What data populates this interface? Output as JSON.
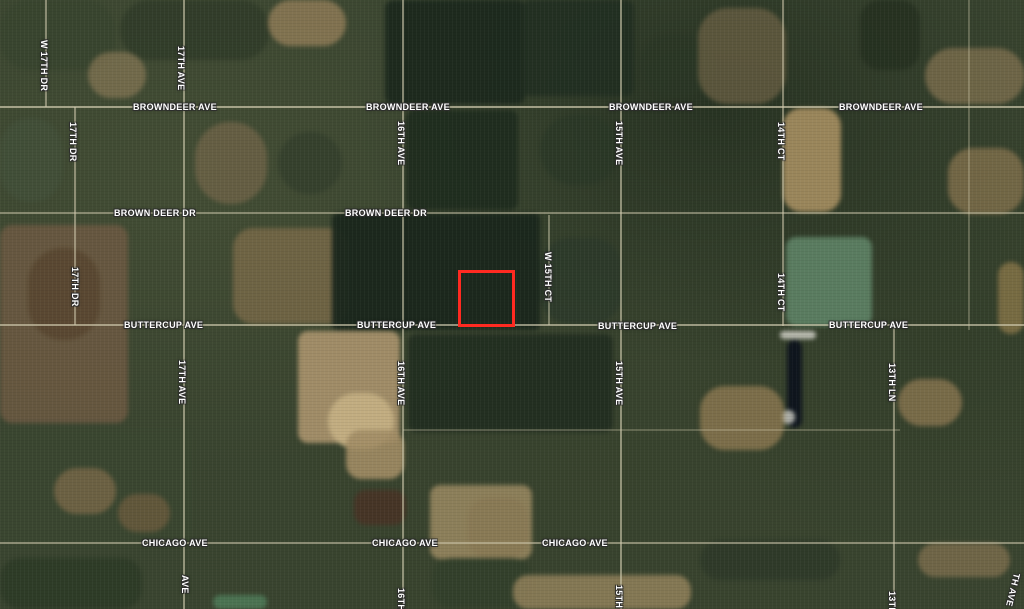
{
  "map": {
    "view": "satellite",
    "highlight": {
      "name": "selected-parcel",
      "x": 458,
      "y": 270,
      "width": 57,
      "height": 57,
      "color": "#ff2a21",
      "stroke_px": 3
    },
    "colors": {
      "label_text": "#ffffff",
      "label_halo": "#2d2d2d",
      "road_line": "#cfc9ad"
    },
    "road_labels": [
      {
        "text": "W 17TH DR",
        "dir": "v",
        "x": 45,
        "y": 40
      },
      {
        "text": "17TH AVE",
        "dir": "v",
        "x": 182,
        "y": 46
      },
      {
        "text": "17TH DR",
        "dir": "v",
        "x": 74,
        "y": 122
      },
      {
        "text": "16TH AVE",
        "dir": "v",
        "x": 402,
        "y": 121
      },
      {
        "text": "15TH AVE",
        "dir": "v",
        "x": 620,
        "y": 121
      },
      {
        "text": "14TH CT",
        "dir": "v",
        "x": 782,
        "y": 122
      },
      {
        "text": "BROWNDEER AVE",
        "dir": "h",
        "x": 133,
        "y": 102
      },
      {
        "text": "BROWNDEER AVE",
        "dir": "h",
        "x": 366,
        "y": 102
      },
      {
        "text": "BROWNDEER AVE",
        "dir": "h",
        "x": 609,
        "y": 102
      },
      {
        "text": "BROWNDEER AVE",
        "dir": "h",
        "x": 839,
        "y": 102
      },
      {
        "text": "BROWN DEER DR",
        "dir": "h",
        "x": 114,
        "y": 208
      },
      {
        "text": "BROWN DEER DR",
        "dir": "h",
        "x": 345,
        "y": 208
      },
      {
        "text": "17TH DR",
        "dir": "v",
        "x": 76,
        "y": 267
      },
      {
        "text": "W 15TH CT",
        "dir": "v",
        "x": 549,
        "y": 252
      },
      {
        "text": "14TH CT",
        "dir": "v",
        "x": 782,
        "y": 273
      },
      {
        "text": "BUTTERCUP AVE",
        "dir": "h",
        "x": 124,
        "y": 320
      },
      {
        "text": "BUTTERCUP AVE",
        "dir": "h",
        "x": 357,
        "y": 320
      },
      {
        "text": "BUTTERCUP AVE",
        "dir": "h",
        "x": 598,
        "y": 321
      },
      {
        "text": "BUTTERCUP AVE",
        "dir": "h",
        "x": 829,
        "y": 320
      },
      {
        "text": "17TH AVE",
        "dir": "v",
        "x": 183,
        "y": 360
      },
      {
        "text": "16TH AVE",
        "dir": "v",
        "x": 402,
        "y": 361
      },
      {
        "text": "15TH AVE",
        "dir": "v",
        "x": 620,
        "y": 361
      },
      {
        "text": "13TH LN",
        "dir": "v",
        "x": 893,
        "y": 363
      },
      {
        "text": "CHICAGO AVE",
        "dir": "h",
        "x": 142,
        "y": 538
      },
      {
        "text": "CHICAGO AVE",
        "dir": "h",
        "x": 372,
        "y": 538
      },
      {
        "text": "CHICAGO AVE",
        "dir": "h",
        "x": 542,
        "y": 538
      },
      {
        "text": "AVE",
        "dir": "v",
        "x": 186,
        "y": 575
      },
      {
        "text": "16TH",
        "dir": "v",
        "x": 402,
        "y": 588
      },
      {
        "text": "15TH",
        "dir": "v",
        "x": 620,
        "y": 585
      },
      {
        "text": "13TH",
        "dir": "v",
        "x": 893,
        "y": 591
      },
      {
        "text": "TH AVE",
        "dir": "v",
        "x": 1014,
        "y": 573,
        "rot": 14
      }
    ],
    "roads": {
      "horizontal": [
        {
          "name": "browndeer-ave",
          "y": 107,
          "x1": 0,
          "x2": 1024,
          "o": 0.7
        },
        {
          "name": "brown-deer-dr",
          "y": 213,
          "x1": 0,
          "x2": 1024,
          "o": 0.5
        },
        {
          "name": "buttercup-ave",
          "y": 325,
          "x1": 0,
          "x2": 1024,
          "o": 0.65
        },
        {
          "name": "field-boundary",
          "y": 430,
          "x1": 403,
          "x2": 900,
          "o": 0.28
        },
        {
          "name": "chicago-ave",
          "y": 543,
          "x1": 0,
          "x2": 1024,
          "o": 0.55
        }
      ],
      "vertical": [
        {
          "name": "w-17th-dr",
          "x": 46,
          "y1": 0,
          "y2": 107,
          "o": 0.55
        },
        {
          "name": "17th-dr",
          "x": 75,
          "y1": 107,
          "y2": 325,
          "o": 0.55
        },
        {
          "name": "17th-ave",
          "x": 184,
          "y1": 0,
          "y2": 609,
          "o": 0.6
        },
        {
          "name": "16th-ave",
          "x": 403,
          "y1": 0,
          "y2": 609,
          "o": 0.6
        },
        {
          "name": "w-15th-ct",
          "x": 549,
          "y1": 215,
          "y2": 325,
          "o": 0.45
        },
        {
          "name": "15th-ave",
          "x": 621,
          "y1": 0,
          "y2": 609,
          "o": 0.6
        },
        {
          "name": "14th-ct",
          "x": 783,
          "y1": 0,
          "y2": 326,
          "o": 0.55
        },
        {
          "name": "13th-ln",
          "x": 894,
          "y1": 325,
          "y2": 609,
          "o": 0.55
        },
        {
          "name": "field-boundary-right",
          "x": 969,
          "y1": 0,
          "y2": 330,
          "o": 0.3
        }
      ]
    },
    "terrain_patches": [
      {
        "x": 0,
        "y": 0,
        "w": 115,
        "h": 70,
        "c": "#39452f",
        "r": 30,
        "o": 0.9
      },
      {
        "x": 120,
        "y": 0,
        "w": 150,
        "h": 60,
        "c": "#2f3b28",
        "r": 40,
        "o": 0.8
      },
      {
        "x": 268,
        "y": 0,
        "w": 78,
        "h": 46,
        "c": "#8d7a56",
        "r": 35,
        "o": 0.85
      },
      {
        "x": 385,
        "y": 0,
        "w": 140,
        "h": 104,
        "c": "#1c291d",
        "r": 8,
        "o": 0.95
      },
      {
        "x": 522,
        "y": 0,
        "w": 112,
        "h": 96,
        "c": "#212f21",
        "r": 8,
        "o": 0.9
      },
      {
        "x": 640,
        "y": 35,
        "w": 72,
        "h": 62,
        "c": "#2b3726",
        "r": 40,
        "o": 0.8
      },
      {
        "x": 698,
        "y": 8,
        "w": 88,
        "h": 96,
        "c": "#6b6044",
        "r": 30,
        "o": 0.75
      },
      {
        "x": 860,
        "y": 0,
        "w": 60,
        "h": 70,
        "c": "#24301f",
        "r": 20,
        "o": 0.8
      },
      {
        "x": 925,
        "y": 48,
        "w": 100,
        "h": 56,
        "c": "#7c6e4d",
        "r": 30,
        "o": 0.8
      },
      {
        "x": 88,
        "y": 52,
        "w": 58,
        "h": 46,
        "c": "#877756",
        "r": 40,
        "o": 0.7
      },
      {
        "x": 0,
        "y": 118,
        "w": 62,
        "h": 84,
        "c": "#42503a",
        "r": 30,
        "o": 0.8
      },
      {
        "x": 195,
        "y": 122,
        "w": 72,
        "h": 82,
        "c": "#75664a",
        "r": 35,
        "o": 0.7
      },
      {
        "x": 278,
        "y": 132,
        "w": 64,
        "h": 62,
        "c": "#333f2c",
        "r": 40,
        "o": 0.8
      },
      {
        "x": 406,
        "y": 110,
        "w": 112,
        "h": 100,
        "c": "#1e2b1e",
        "r": 8,
        "o": 0.9
      },
      {
        "x": 540,
        "y": 115,
        "w": 80,
        "h": 70,
        "c": "#2a3726",
        "r": 40,
        "o": 0.7
      },
      {
        "x": 783,
        "y": 108,
        "w": 58,
        "h": 104,
        "c": "#a08a5e",
        "r": 18,
        "o": 0.95
      },
      {
        "x": 948,
        "y": 148,
        "w": 76,
        "h": 66,
        "c": "#82704c",
        "r": 25,
        "o": 0.8
      },
      {
        "x": 0,
        "y": 225,
        "w": 128,
        "h": 198,
        "c": "#6a5941",
        "r": 12,
        "o": 0.9
      },
      {
        "x": 28,
        "y": 248,
        "w": 72,
        "h": 92,
        "c": "#57452f",
        "r": 35,
        "o": 0.8
      },
      {
        "x": 233,
        "y": 228,
        "w": 116,
        "h": 96,
        "c": "#7b6a49",
        "r": 20,
        "o": 0.8
      },
      {
        "x": 332,
        "y": 213,
        "w": 208,
        "h": 117,
        "c": "#1a271c",
        "r": 6,
        "o": 0.95
      },
      {
        "x": 540,
        "y": 238,
        "w": 82,
        "h": 86,
        "c": "#2c3a2a",
        "r": 30,
        "o": 0.8
      },
      {
        "x": 786,
        "y": 237,
        "w": 86,
        "h": 89,
        "c": "#5d7f63",
        "r": 10,
        "o": 0.95
      },
      {
        "x": 998,
        "y": 262,
        "w": 26,
        "h": 72,
        "c": "#887648",
        "r": 20,
        "o": 0.8
      },
      {
        "x": 298,
        "y": 331,
        "w": 102,
        "h": 112,
        "c": "#a5906a",
        "r": 10,
        "o": 0.95
      },
      {
        "x": 328,
        "y": 393,
        "w": 66,
        "h": 56,
        "c": "#c6b184",
        "r": 35,
        "o": 0.9
      },
      {
        "x": 780,
        "y": 331,
        "w": 36,
        "h": 8,
        "c": "#c9c9bf",
        "r": 20,
        "o": 0.9
      },
      {
        "x": 787,
        "y": 340,
        "w": 15,
        "h": 88,
        "c": "#0d131c",
        "r": 20,
        "o": 0.95
      },
      {
        "x": 782,
        "y": 410,
        "w": 13,
        "h": 14,
        "c": "#c5c6bd",
        "r": 40,
        "o": 0.85
      },
      {
        "x": 700,
        "y": 386,
        "w": 84,
        "h": 64,
        "c": "#8d7951",
        "r": 25,
        "o": 0.8
      },
      {
        "x": 898,
        "y": 379,
        "w": 64,
        "h": 47,
        "c": "#897550",
        "r": 25,
        "o": 0.8
      },
      {
        "x": 408,
        "y": 334,
        "w": 205,
        "h": 98,
        "c": "#212e20",
        "r": 8,
        "o": 0.9
      },
      {
        "x": 0,
        "y": 428,
        "w": 192,
        "h": 116,
        "c": "#3b4731",
        "r": 10,
        "o": 0.7
      },
      {
        "x": 54,
        "y": 468,
        "w": 62,
        "h": 46,
        "c": "#796849",
        "r": 35,
        "o": 0.8
      },
      {
        "x": 118,
        "y": 494,
        "w": 52,
        "h": 38,
        "c": "#6c5b3f",
        "r": 35,
        "o": 0.8
      },
      {
        "x": 346,
        "y": 430,
        "w": 58,
        "h": 49,
        "c": "#a28d65",
        "r": 15,
        "o": 0.9
      },
      {
        "x": 354,
        "y": 490,
        "w": 52,
        "h": 35,
        "c": "#483426",
        "r": 12,
        "o": 0.9
      },
      {
        "x": 430,
        "y": 485,
        "w": 102,
        "h": 74,
        "c": "#9b8961",
        "r": 10,
        "o": 0.85
      },
      {
        "x": 468,
        "y": 498,
        "w": 60,
        "h": 60,
        "c": "#897955",
        "r": 20,
        "o": 0.8
      },
      {
        "x": 432,
        "y": 558,
        "w": 100,
        "h": 50,
        "c": "#32402b",
        "r": 20,
        "o": 0.8
      },
      {
        "x": 513,
        "y": 575,
        "w": 178,
        "h": 34,
        "c": "#92815b",
        "r": 15,
        "o": 0.85
      },
      {
        "x": 213,
        "y": 595,
        "w": 54,
        "h": 14,
        "c": "#4e7957",
        "r": 45,
        "o": 0.9
      },
      {
        "x": 700,
        "y": 540,
        "w": 140,
        "h": 40,
        "c": "#2a3626",
        "r": 30,
        "o": 0.6
      },
      {
        "x": 918,
        "y": 543,
        "w": 92,
        "h": 34,
        "c": "#7d6e4d",
        "r": 25,
        "o": 0.8
      },
      {
        "x": 0,
        "y": 558,
        "w": 142,
        "h": 51,
        "c": "#2c3926",
        "r": 20,
        "o": 0.8
      }
    ]
  }
}
